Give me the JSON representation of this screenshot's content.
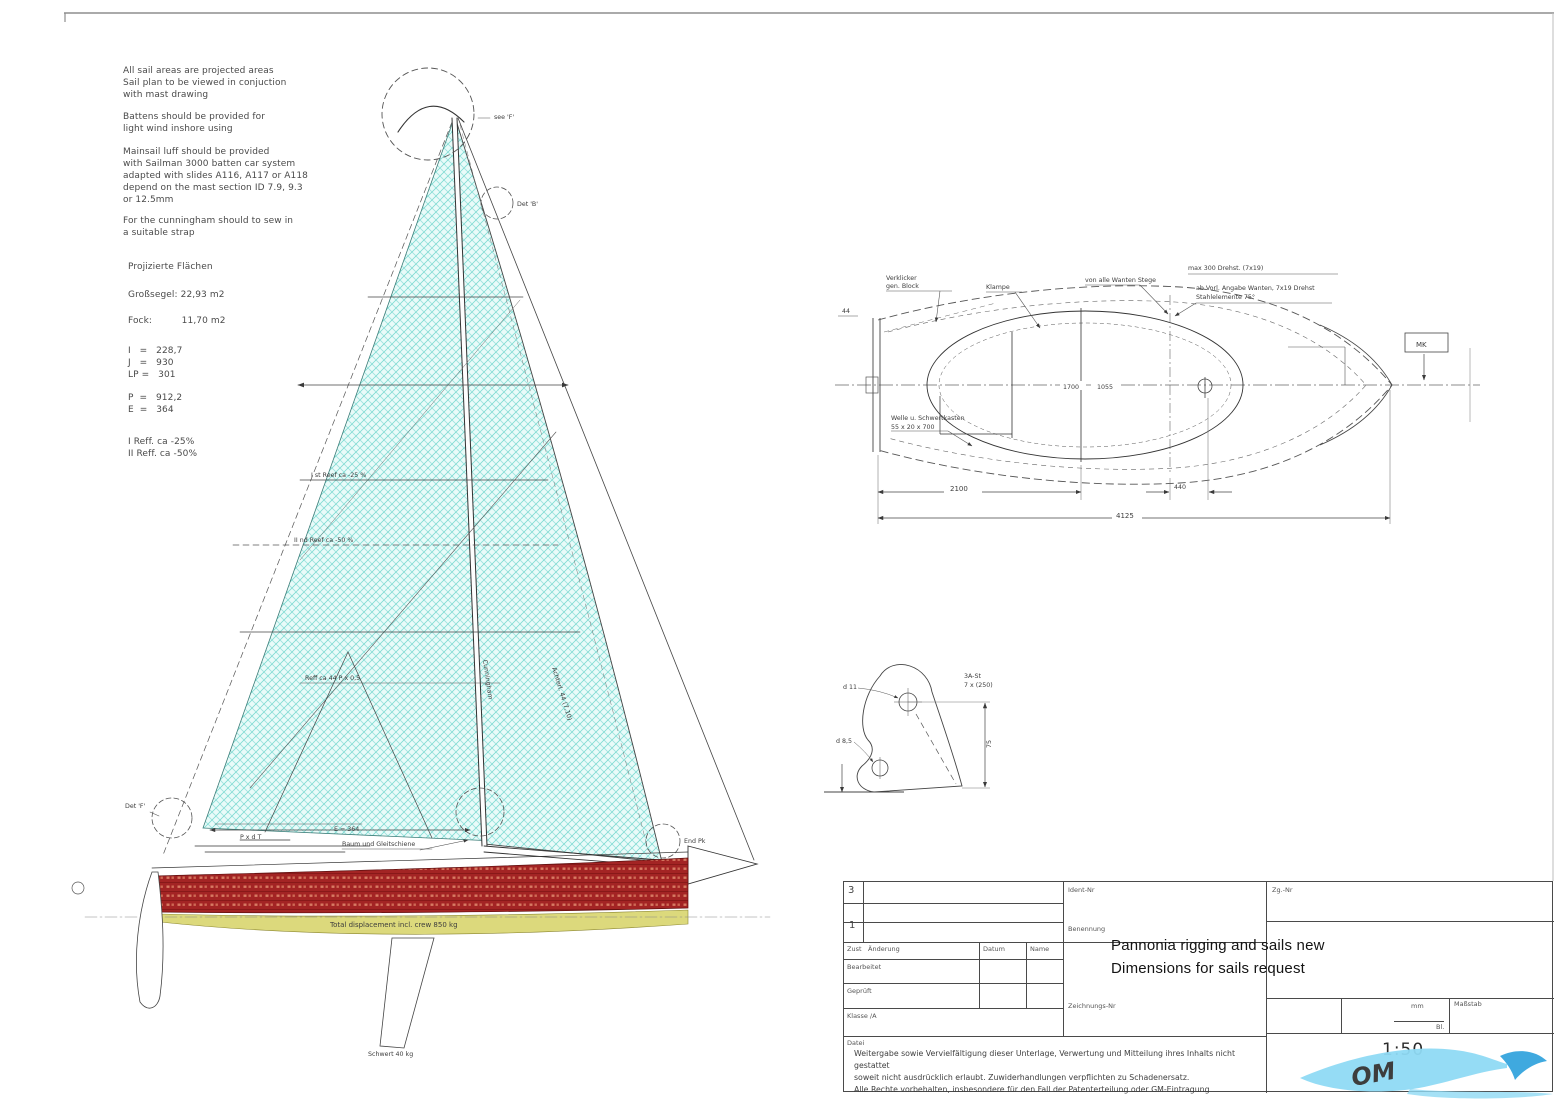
{
  "colors": {
    "sail_bg": "#e9fbf9",
    "sail_hatch": "#5fd0c7",
    "hull_red": "#a32424",
    "hull_red_dot": "#d77b63",
    "stripe_yellow": "#dcd97c",
    "line": "#3a3a3a",
    "watermark_light": "#8fdaf4",
    "watermark_dark": "#1565c0"
  },
  "notes": {
    "block1": "All sail areas are projected areas\nSail plan to be viewed in conjuction\nwith mast drawing",
    "block2": "Battens should be provided for\nlight wind inshore using",
    "block3": "Mainsail luff should be provided\nwith Sailman 3000 batten car system\nadapted with slides A116, A117 or A118\ndepend on the mast section ID 7.9, 9.3\nor 12.5mm",
    "block4": "For the cunningham should to sew in\na suitable strap"
  },
  "areas": {
    "title": "Projizierte Flächen",
    "main": "Großsegel: 22,93 m2",
    "jib": "Fock:          11,70 m2",
    "dims_fore": "I   =   228,7\nJ   =   930\nLP =   301",
    "dims_main": "P  =   912,2\nE  =   364",
    "reefs": "I Reff. ca -25%\nII Reff. ca -50%"
  },
  "sailplan": {
    "masthead_note": "see 'F'",
    "det_b": "Det 'B'",
    "det_f": "Det 'F'",
    "end_pk": "End Pk",
    "reef1": "I st Reef ca -25 %",
    "reef2": "II nd Reef ca -50 %",
    "reef3": "Reff ca 44  P x 0,5",
    "cunningham": "Cunningham",
    "leech": "Achterl. 44 (7,10)",
    "boom_dim1": "P x d T",
    "boom_dim2": "E = 364",
    "boom_label": "Baum und Gleitschiene",
    "displacement": "Total displacement incl. crew 850 kg",
    "keel": "Schwert 40 kg"
  },
  "deckplan": {
    "c1a": "Verklicker",
    "c1b": "gen. Block",
    "c2": "Klampe",
    "c3": "von alle Wanten Stege",
    "c4": "max 300 Drehst. (7x19)",
    "c5a": "ab Vorl. Angabe Wanten, 7x19 Drehst",
    "c5b": "Stahlelemente 75°",
    "c6a": "Welle u. Schwertkasten",
    "c6b": "55 x 20 x 700",
    "left_dim": "44",
    "mk": "MK",
    "dim_1700": "1700",
    "dim_1055": "1055",
    "dim_2100": "2100",
    "dim_440": "440",
    "dim_total": "4125"
  },
  "bracket": {
    "note1": "3A-St",
    "note2": "7 x (250)",
    "d_top": "d 11",
    "d_bottom": "d 8,5",
    "height": "75"
  },
  "titleblock": {
    "ident_label": "Ident-Nr",
    "zgnr_label": "Zg.-Nr",
    "benennung_label": "Benennung",
    "zeichnr_label": "Zeichnungs-Nr",
    "zust": "Zust",
    "aenderung": "Änderung",
    "datum": "Datum",
    "name": "Name",
    "bearb": "Bearbeitet",
    "gepr": "Geprüft",
    "klasse": "Klasse /A",
    "date": "Datei",
    "rev_a": "3",
    "rev_b": "1",
    "mm": "mm",
    "massstab": "Maßstab",
    "bl": "Bl.",
    "title1": "Pannonia rigging and sails new",
    "title2": "Dimensions for sails request",
    "scale": "1:50",
    "disclaimer": "Weitergabe sowie Vervielfältigung dieser Unterlage, Verwertung und Mitteilung ihres Inhalts nicht gestattet\nsoweit nicht ausdrücklich erlaubt. Zuwiderhandlungen verpflichten zu Schadenersatz.\nAlle Rechte vorbehalten, insbesondere für den Fall der Patenterteilung oder GM-Eintragung"
  },
  "watermark": {
    "text": "OM"
  }
}
